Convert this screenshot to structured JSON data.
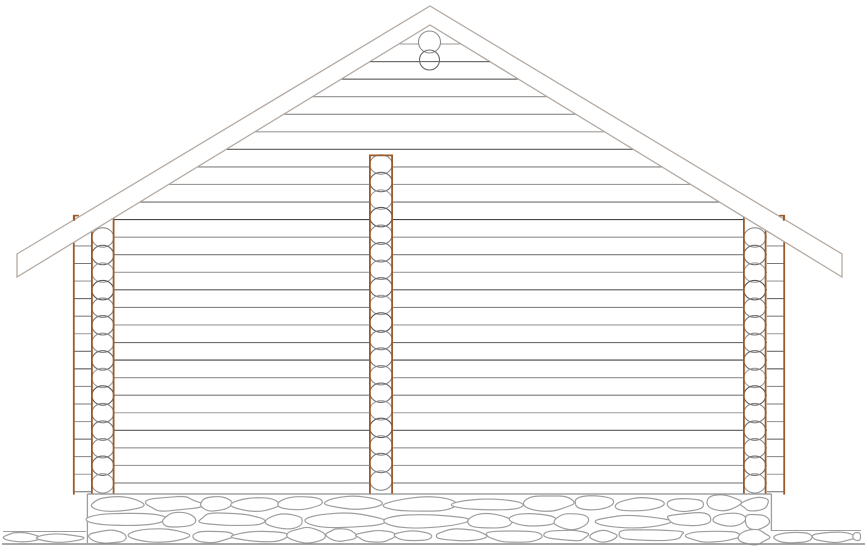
{
  "meta": {
    "title": "Log house gable elevation drawing",
    "drawing_type": "architectural elevation",
    "visible_text": "none"
  },
  "canvas": {
    "width": 868,
    "height": 548,
    "background": "#ffffff"
  },
  "colors": {
    "roof_edge": "#b5aaa2",
    "log_line_shades": [
      "#9a9a9a",
      "#6e6e6e",
      "#454545",
      "#8f8f8f",
      "#7a7a7a",
      "#9c9c9c",
      "#5a5a5a",
      "#828282"
    ],
    "circle_shades": [
      "#8d8d8d",
      "#6a6a6a",
      "#9b9b9b",
      "#585858",
      "#858585",
      "#757575"
    ],
    "timber": "#9b5a2a",
    "stone": "#9e9e9e",
    "ground": "#8a8a8a",
    "white": "#ffffff"
  },
  "roof": {
    "peak_x": 430,
    "outer_peak_y": 6,
    "inner_peak_y": 25,
    "left_end_x": 17,
    "right_end_x": 842,
    "outer_end_y": 254,
    "inner_end_y": 277
  },
  "log_courses": {
    "first_y": 44,
    "spacing": 17.56,
    "count": 26
  },
  "wall": {
    "left": 73,
    "right": 785,
    "bottom": 494,
    "corner_top": 242.8
  },
  "ridge_log_ends": [
    {
      "cx": 429.5,
      "cy": 42,
      "r": 11
    },
    {
      "cx": 429.5,
      "cy": 60,
      "r": 10
    }
  ],
  "overlay_course_index": 1,
  "corner_strips": [
    {
      "side": "left",
      "x0": 73,
      "x1": 91,
      "top": 222,
      "edge_x": 73.8,
      "edge_top": 215
    },
    {
      "side": "right",
      "x0": 767,
      "x1": 785,
      "top": 222,
      "edge_x": 784.2,
      "edge_top": 215
    }
  ],
  "strip_lines": {
    "first_y": 52.78,
    "min_y": 226,
    "max_y": 492
  },
  "log_columns": [
    {
      "name": "left-corner",
      "x0": 91,
      "x1": 114.5,
      "top": 214,
      "first_cy": 237.5,
      "cap_top": false
    },
    {
      "name": "middle",
      "x0": 369,
      "x1": 393,
      "top": 154.5,
      "first_cy": 164.5,
      "cap_top": true
    },
    {
      "name": "right-corner",
      "x0": 743,
      "x1": 766.5,
      "top": 214,
      "first_cy": 237.5,
      "cap_top": false
    }
  ],
  "column_bottom": 494.6,
  "circle_ry": 9.7,
  "circle_max_cy": 489,
  "bottom_caps": [
    [
      73,
      114.5
    ],
    [
      369,
      393
    ],
    [
      743,
      785
    ]
  ],
  "roof_ticks": [
    {
      "x": 74.2,
      "cap_x0": 73.4,
      "cap_x1": 78.8
    },
    {
      "x": 783.8,
      "cap_x0": 779.2,
      "cap_x1": 784.6
    }
  ],
  "foundation": {
    "x0": 88,
    "x1": 771,
    "top": 494,
    "left_edge_x": 87.4,
    "left_edge_bottom": 543,
    "right_edge_x": 771.4,
    "right_edge_bottom": 531,
    "rows": [
      {
        "y": 495,
        "h": 17,
        "avg_w": 56
      },
      {
        "y": 512,
        "h": 17,
        "avg_w": 62
      },
      {
        "y": 529,
        "h": 14,
        "avg_w": 50
      }
    ]
  },
  "ground": {
    "line_y": 544,
    "x0": 2,
    "x1": 865,
    "left_band": {
      "x0": 3,
      "x1": 86,
      "line_y": 531.5,
      "y": 533,
      "h": 10,
      "avg_w": 36
    },
    "right_band": {
      "x0": 772,
      "x1": 861,
      "line_y": 530.5,
      "y": 532,
      "h": 11,
      "avg_w": 44
    }
  },
  "random_seed": 11
}
